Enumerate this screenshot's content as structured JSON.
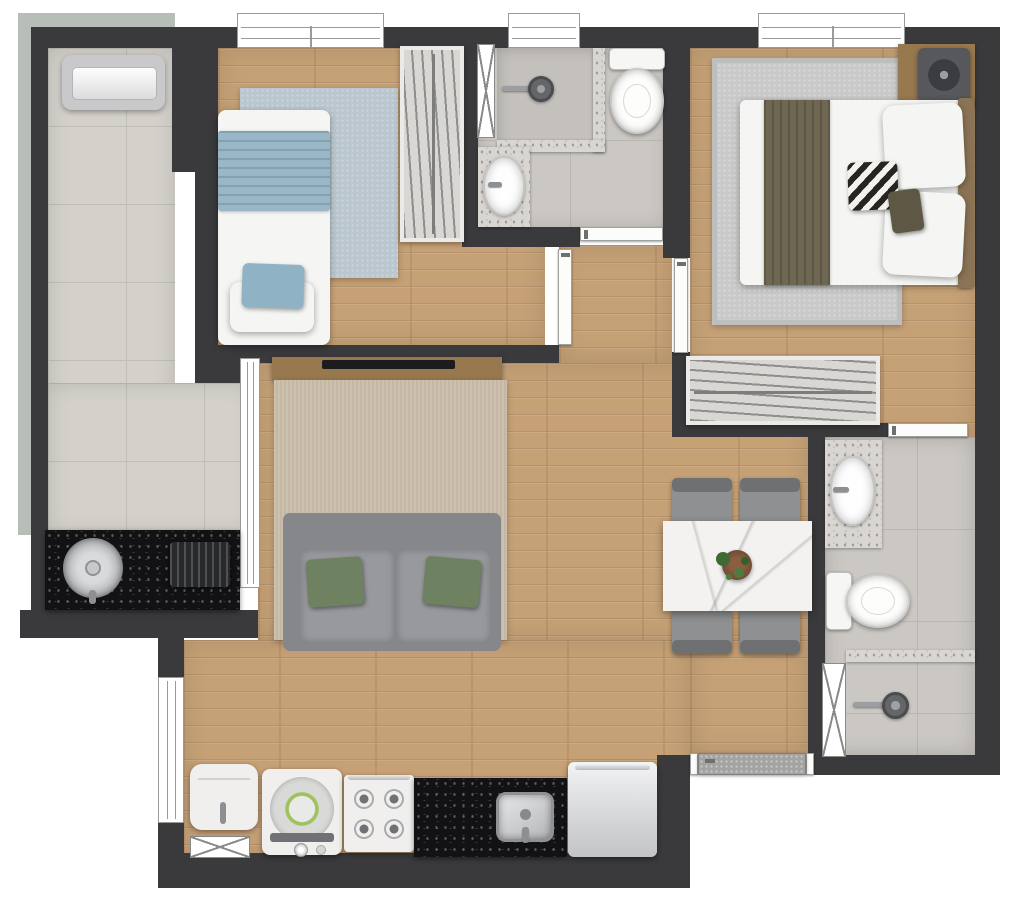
{
  "palette": {
    "wall": "#3a3a3c",
    "sage": "#b6beb7",
    "tile": "#d4d1cb",
    "tile_line": "#c1beb8",
    "bath_tile": "#cbc8c3",
    "bath_tile_line": "#bab7b2",
    "shower_tile": "#c4c1bc",
    "wood": "#c6a176",
    "rug_blue": "#bac7cf",
    "rug_gray": "#c8c9c8",
    "rug_beige": "#ccc0ae",
    "rug_beige_2": "#c4b8a5",
    "granite_dark": "#121214",
    "granite_light": "#d9d6d1",
    "sofa": "#85878a",
    "sofa_seat": "#97999d",
    "cushion": "#6e8161",
    "blanket_blue": "#99b7c6",
    "blanket_olive": "#6e6751",
    "furniture_wood": "#97784f",
    "appliance": "#f0efed",
    "fridge": "#d7d8da",
    "chrome": "#b9babc",
    "marble": "#f3f2f0",
    "chair": "#8e9092",
    "chair_back": "#6e7072",
    "door": "#fcfcfb",
    "door_entry": "#a3a3a1",
    "plant": "#3e6b34",
    "pot": "#6b4a35"
  },
  "plan": {
    "type": "apartment-floor-plan",
    "rooms": [
      {
        "id": "balcony-terrace",
        "floor": "tile",
        "items": [
          "ac-condenser-unit",
          "gourmet-counter-black-granite",
          "round-sink",
          "built-in-grill"
        ]
      },
      {
        "id": "bedroom-1",
        "floor": "wood",
        "items": [
          "single-bed",
          "blue-blanket",
          "blue-pillow",
          "blue-rug",
          "wardrobe-hanger-rack",
          "window"
        ]
      },
      {
        "id": "bathroom-1",
        "floor": "tile",
        "items": [
          "shower-head",
          "shower-enclosure",
          "toilet",
          "sink-counter",
          "oval-sink",
          "window",
          "duct-shaft"
        ]
      },
      {
        "id": "master-bedroom",
        "floor": "wood",
        "items": [
          "double-bed",
          "olive-blanket",
          "chevron-pillow",
          "white-pillows",
          "gray-rug",
          "fan-unit",
          "wardrobe-hanger-rack",
          "window"
        ]
      },
      {
        "id": "bathroom-2",
        "floor": "tile",
        "items": [
          "sink-counter",
          "oval-sink",
          "toilet",
          "shower-head",
          "glass-divider",
          "duct-shaft"
        ]
      },
      {
        "id": "living-dining",
        "floor": "wood",
        "items": [
          "tv-console",
          "tv",
          "striped-rug",
          "two-seat-sofa",
          "green-cushions",
          "marble-dining-table",
          "four-chairs",
          "plant-centerpiece"
        ]
      },
      {
        "id": "kitchen",
        "floor": "wood",
        "items": [
          "water-heater",
          "washing-machine",
          "stove-4-burners",
          "black-granite-counter",
          "square-sink",
          "fridge",
          "window",
          "duct-shaft"
        ]
      },
      {
        "id": "entry-foyer",
        "floor": "wood",
        "items": [
          "entrance-door"
        ]
      }
    ],
    "doors": [
      "bedroom-1-door",
      "master-bedroom-door",
      "bathroom-1-door",
      "bathroom-2-door",
      "entrance-door"
    ],
    "windows": [
      "bedroom-1-window",
      "bathroom-1-window",
      "master-bedroom-window",
      "balcony-glass-door",
      "kitchen-window"
    ]
  }
}
